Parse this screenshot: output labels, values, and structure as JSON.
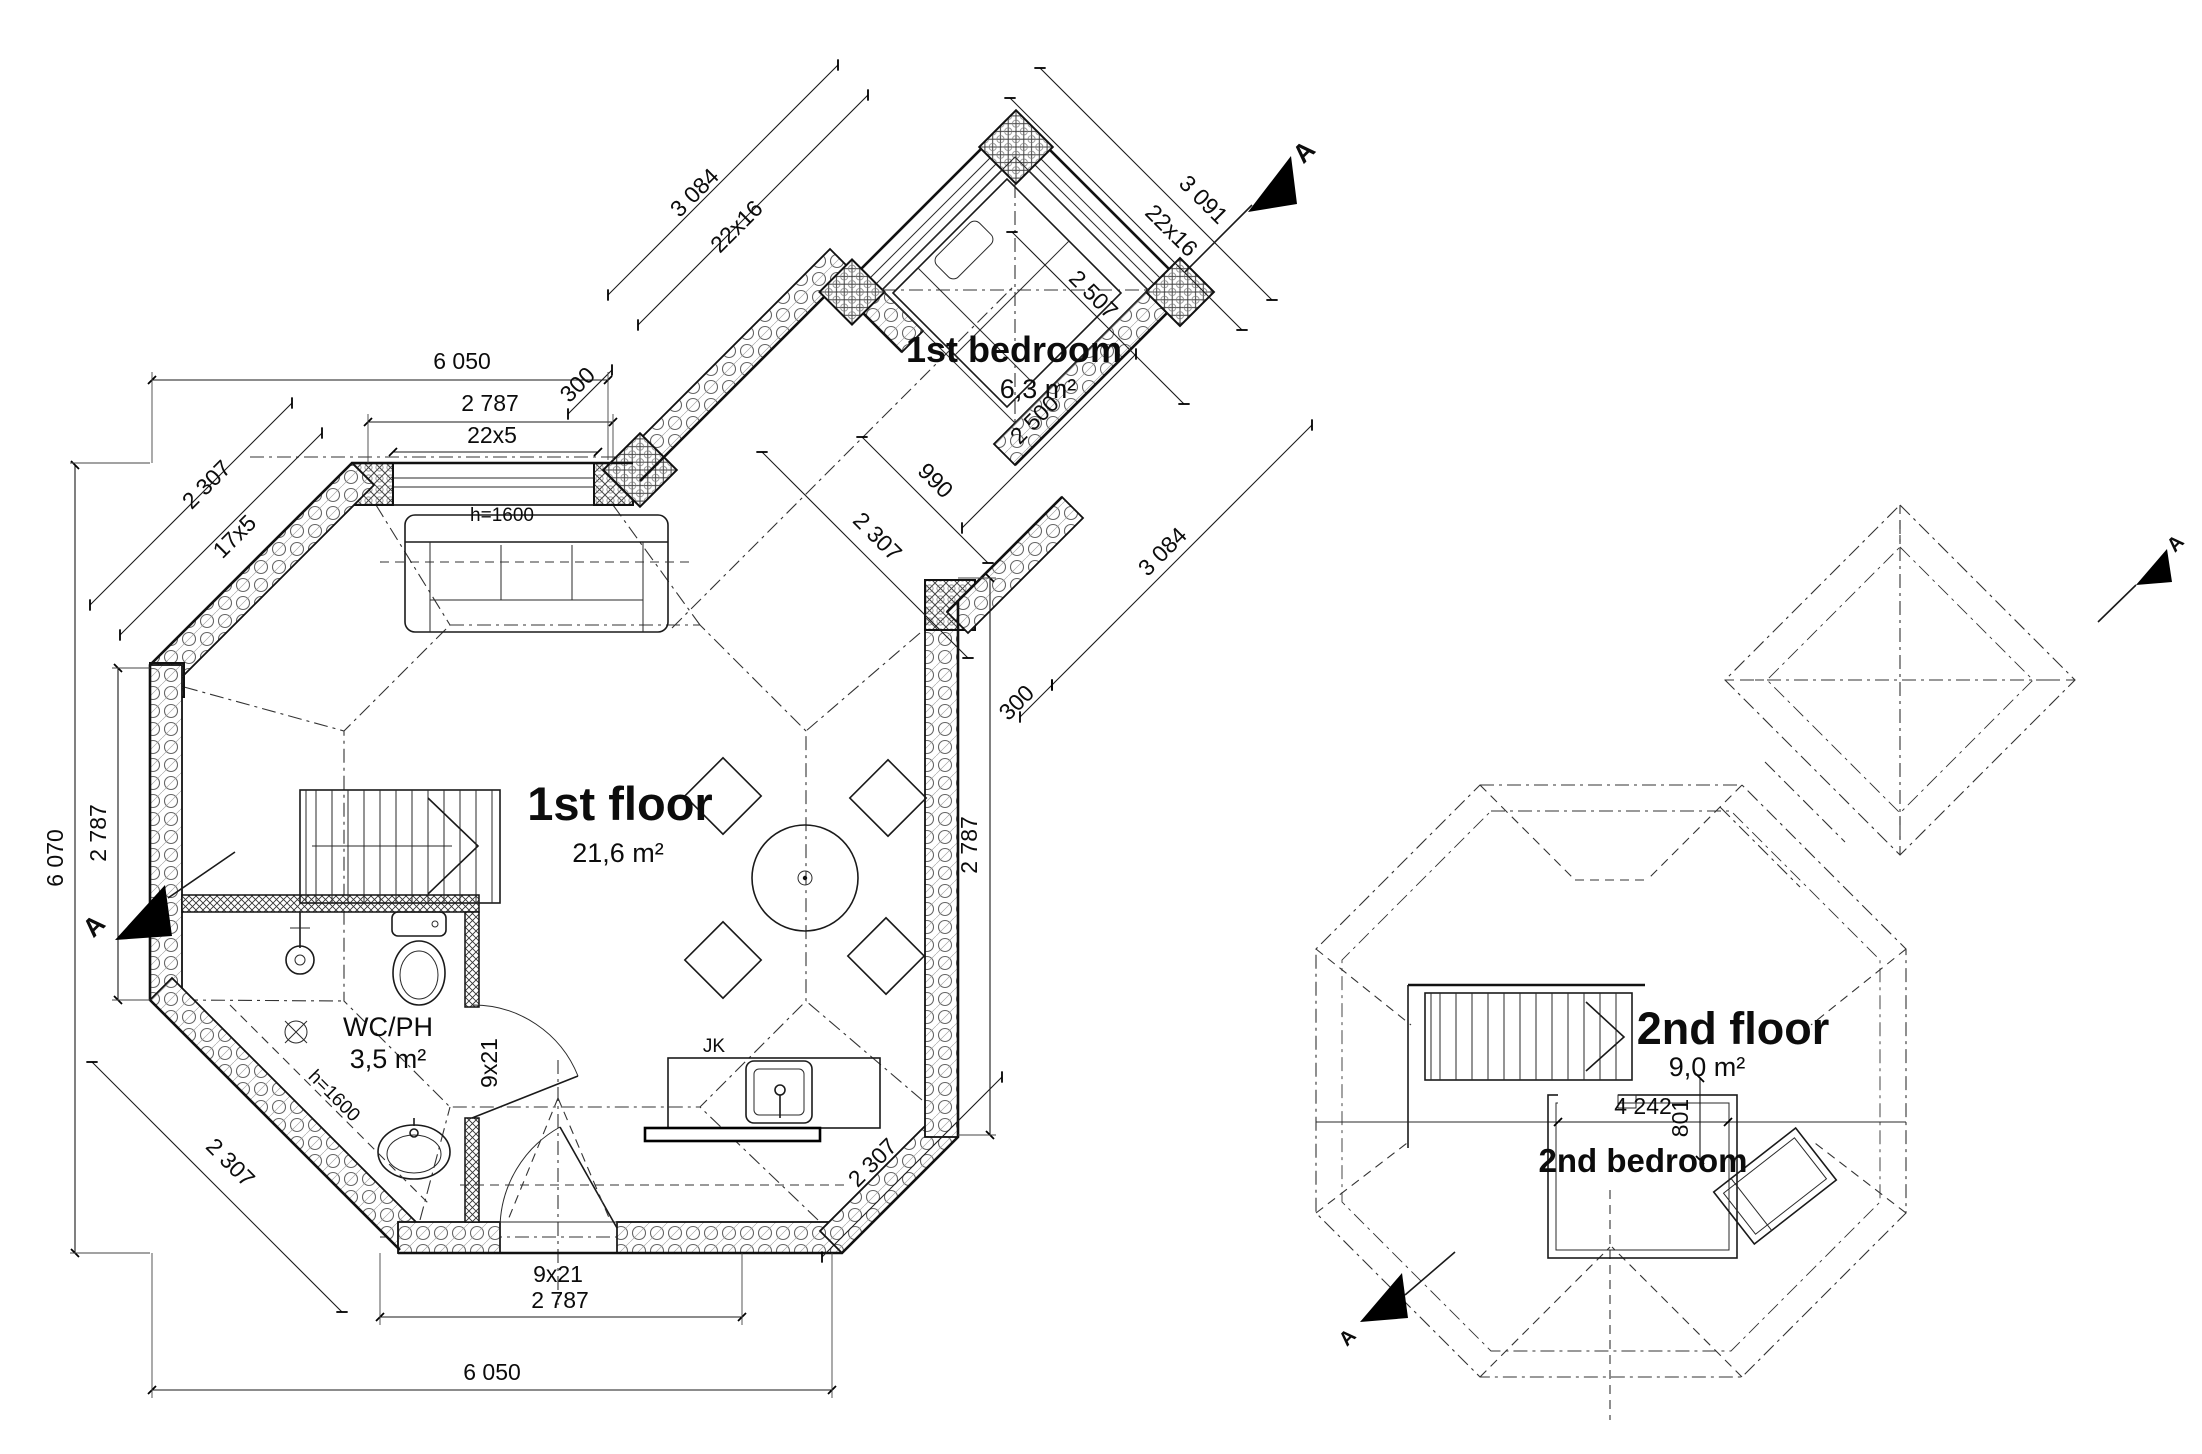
{
  "floor1": {
    "title": "1st floor",
    "area": "21,6 m²",
    "bedroom": {
      "title": "1st bedroom",
      "area": "6,3 m²"
    },
    "wc": {
      "title": "WC/PH",
      "area": "3,5 m²",
      "height_note": "h=1600",
      "door_size": "9x21"
    },
    "sofa_height_note": "h=1600",
    "kitchen_unit_label": "JK",
    "entrance_door_size": "9x21",
    "section_label": "A",
    "dims": {
      "top_overall": "6 050",
      "top_room_width": "2 787",
      "top_window": "22x5",
      "top_wall": "300",
      "left_overall": "6 070",
      "left_room": "2 787",
      "upper_left_wall": "2 307",
      "upper_left_window": "17x5",
      "lower_left_wall": "2 307",
      "bottom_room_width": "2 787",
      "bottom_overall": "6 050",
      "right_room": "2 787",
      "right_wall": "300",
      "lower_right_wall": "2 307",
      "wing_upper_left": "3 084",
      "wing_upper_left_window": "22x16",
      "wing_upper_right": "3 091",
      "wing_upper_right_window": "22x16",
      "wing_lower_right": "3 084",
      "bedroom_width": "2 507",
      "bedroom_depth": "2 500",
      "corridor_opening": "990",
      "corridor_wall": "2 307"
    }
  },
  "floor2": {
    "title": "2nd floor",
    "area": "9,0 m²",
    "bedroom_title": "2nd bedroom",
    "dims": {
      "room_width": "4 242",
      "room_offset": "801"
    },
    "section_label": "A"
  }
}
